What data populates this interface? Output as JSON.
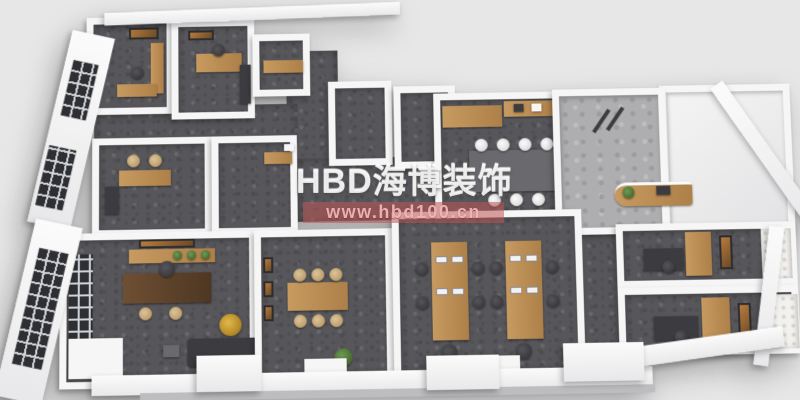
{
  "watermark": {
    "brand": "HBD海博装饰",
    "url": "www.hbd100.cn",
    "brand_color": "#ffffff",
    "band_color": "#be5555",
    "url_color": "#f5bcbc"
  },
  "colors": {
    "page_background": "#e7e7e7",
    "walls": "#f6f6f6",
    "carpet_dark_gray": "#57575b",
    "reception_tile_light_gray": "#aeaeb0",
    "wood_furniture": "#c79a60",
    "dark_furniture": "#3c3c40",
    "gold_lamp": "#e3b84a",
    "plant_green": "#6d9b55",
    "window_frame": "#2f2f33"
  },
  "scene": {
    "type": "3d-office-floorplan-render",
    "rooms": [
      {
        "name": "manager-office-1",
        "furniture": [
          "wall-art",
          "l-shaped-wood-desk",
          "office-chair",
          "window-wall"
        ]
      },
      {
        "name": "manager-office-2",
        "furniture": [
          "wall-art",
          "wood-desk",
          "office-chair",
          "dark-cabinet"
        ]
      },
      {
        "name": "pantry-room",
        "furniture": [
          "wood-cabinet"
        ]
      },
      {
        "name": "storage-room-1",
        "furniture": []
      },
      {
        "name": "storage-room-2",
        "furniture": []
      },
      {
        "name": "interview-room",
        "furniture": [
          "wood-desk",
          "two-rattan-chairs",
          "side-cabinet"
        ]
      },
      {
        "name": "phone-booth-room",
        "furniture": [
          "wall-desk",
          "mirror"
        ]
      },
      {
        "name": "executive-office",
        "furniture": [
          "window-wall",
          "wood-sideboard",
          "wall-art",
          "plants",
          "executive-desk",
          "desk-chair",
          "two-guest-chairs",
          "gold-floor-lamp",
          "dark-sofa",
          "white-console"
        ]
      },
      {
        "name": "meeting-room",
        "furniture": [
          "three-wall-artworks",
          "wood-table",
          "six-rattan-chairs",
          "plant"
        ]
      },
      {
        "name": "conference-room",
        "furniture": [
          "wood-feature-wall",
          "wood-wall-shelf",
          "long-dark-table",
          "seven-white-chairs",
          "glass-partition"
        ]
      },
      {
        "name": "reception",
        "furniture": [
          "entrance-gates",
          "curved-wood-reception-desk",
          "plant"
        ]
      },
      {
        "name": "bright-empty-room",
        "furniture": []
      },
      {
        "name": "open-office",
        "furniture": [
          "workstation-cluster-1",
          "workstation-cluster-2",
          "eight-monitors",
          "ten-office-chairs"
        ]
      },
      {
        "name": "private-office-1",
        "furniture": [
          "wood-bookshelf",
          "desk",
          "office-chair",
          "wall-art",
          "quilted-wall-panel"
        ]
      },
      {
        "name": "private-office-2",
        "furniture": [
          "wood-bookshelf",
          "desk",
          "office-chair",
          "wall-art",
          "quilted-wall-panel"
        ]
      }
    ]
  }
}
